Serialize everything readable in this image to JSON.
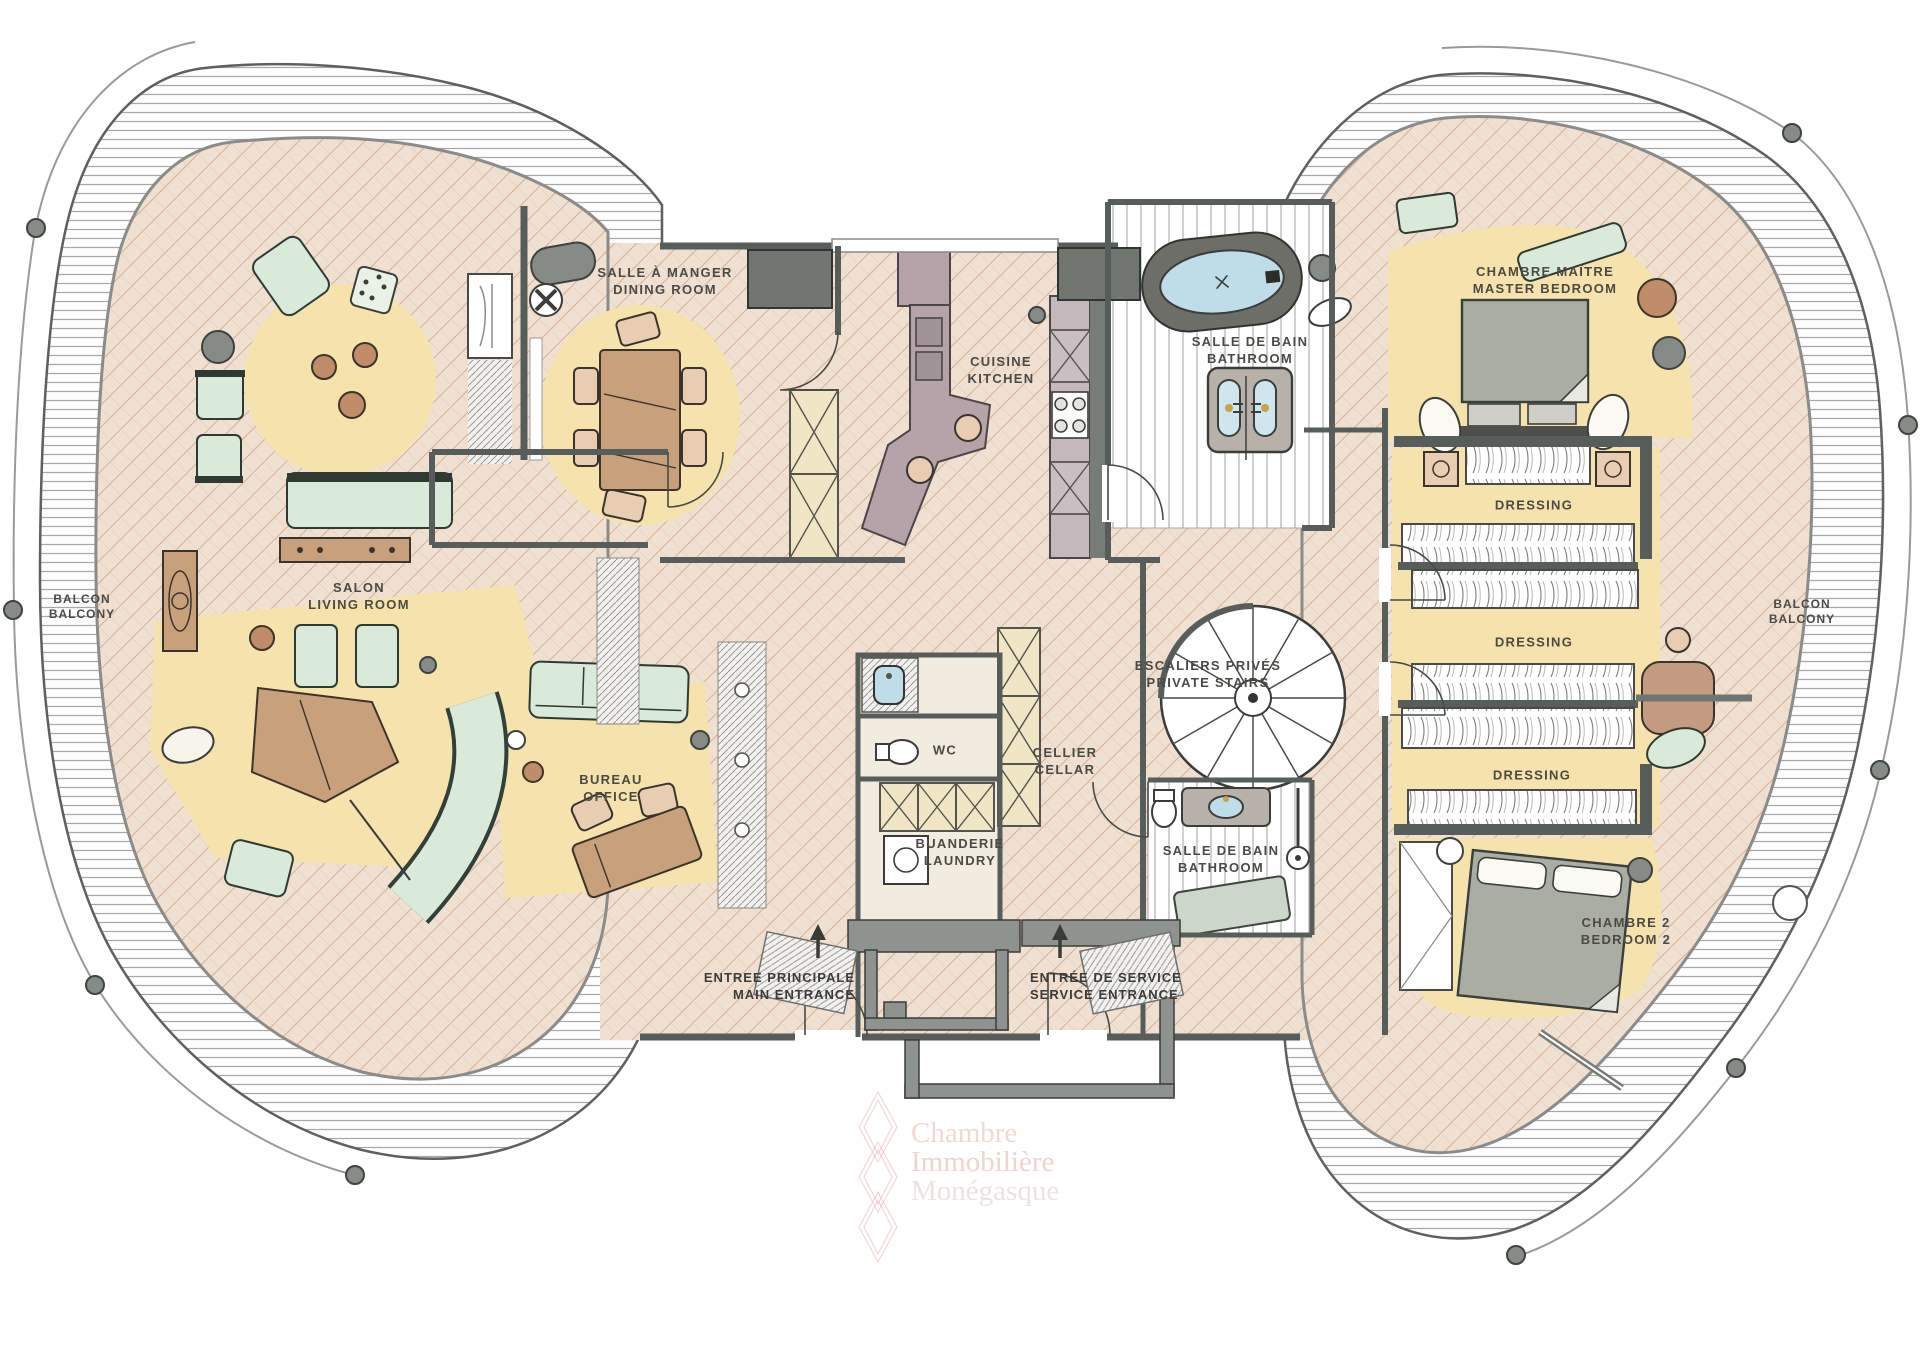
{
  "palette": {
    "floor": "#efe0d1",
    "floorline": "#d7b29c",
    "floorline2": "#e4c9b5",
    "rug": "#f5e2ad",
    "green": "#d9e9da",
    "brown": "#c9a07c",
    "mauve": "#b5a3a9",
    "wall": "#575d5a",
    "gray": "#868b88",
    "water": "#bfdde8",
    "label": "#4c4a45"
  },
  "rooms": [
    {
      "id": "dining-room",
      "fr": "SALLE À MANGER",
      "en": "DINING ROOM"
    },
    {
      "id": "kitchen",
      "fr": "CUISINE",
      "en": "KITCHEN"
    },
    {
      "id": "bathroom-main",
      "fr": "SALLE DE BAIN",
      "en": "BATHROOM"
    },
    {
      "id": "master-bedroom",
      "fr": "CHAMBRE MAÎTRE",
      "en": "MASTER BEDROOM"
    },
    {
      "id": "living-room",
      "fr": "SALON",
      "en": "LIVING ROOM"
    },
    {
      "id": "office",
      "fr": "BUREAU",
      "en": "OFFICE"
    },
    {
      "id": "cellar",
      "fr": "CELLIER",
      "en": "CELLAR"
    },
    {
      "id": "laundry",
      "fr": "BUANDERIE",
      "en": "LAUNDRY"
    },
    {
      "id": "private-stairs",
      "fr": "ESCALIERS PRIVÉS",
      "en": "PRIVATE STAIRS"
    },
    {
      "id": "bathroom-2",
      "fr": "SALLE DE BAIN",
      "en": "BATHROOM"
    },
    {
      "id": "bedroom-2",
      "fr": "CHAMBRE 2",
      "en": "BEDROOM 2"
    },
    {
      "id": "balcony-left",
      "fr": "BALCON",
      "en": "BALCONY"
    },
    {
      "id": "balcony-right",
      "fr": "BALCON",
      "en": "BALCONY"
    }
  ],
  "dressing_labels": [
    "DRESSING",
    "DRESSING",
    "DRESSING"
  ],
  "wc_label": "WC",
  "entrances": [
    {
      "id": "main-entrance",
      "fr": "ENTREE PRINCIPALE",
      "en": "MAIN ENTRANCE"
    },
    {
      "id": "service-entrance",
      "fr": "ENTRÉE DE SERVICE",
      "en": "SERVICE ENTRANCE"
    }
  ],
  "watermark": {
    "line1": "Chambre",
    "line2": "Immobilière",
    "line3": "Monégasque"
  }
}
